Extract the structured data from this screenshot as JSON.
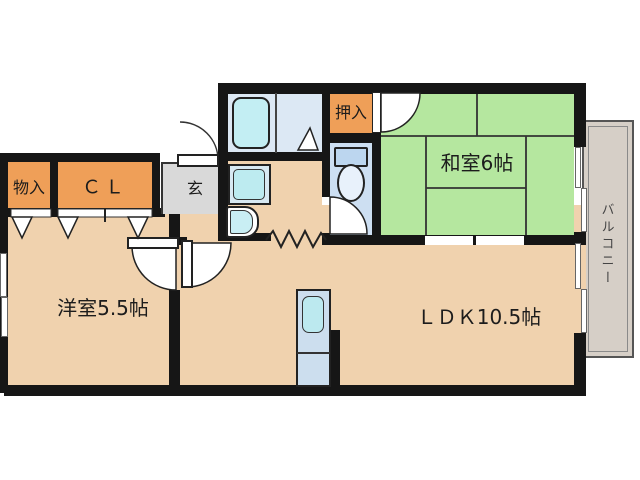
{
  "floorplan": {
    "rooms": {
      "storage": {
        "label": "物入"
      },
      "closet": {
        "label": "ＣＬ"
      },
      "entrance": {
        "label": "玄"
      },
      "futon_closet": {
        "label": "押入"
      },
      "japanese_room": {
        "label": "和室6帖"
      },
      "western_room": {
        "label": "洋室5.5帖"
      },
      "ldk": {
        "label": "ＬＤＫ10.5帖"
      },
      "balcony": {
        "label": "バルコニー"
      }
    },
    "colors": {
      "wall": "#161616",
      "floor_tan": "#f0d2ae",
      "tatami_green": "#b5e79f",
      "closet_orange": "#ef9f58",
      "entrance_gray": "#d9d9d9",
      "bathroom_blue": "#dce8f4",
      "toilet_blue": "#cddff2",
      "fixture_cyan": "#bdebf0",
      "balcony_gray": "#d6cfc7"
    }
  }
}
